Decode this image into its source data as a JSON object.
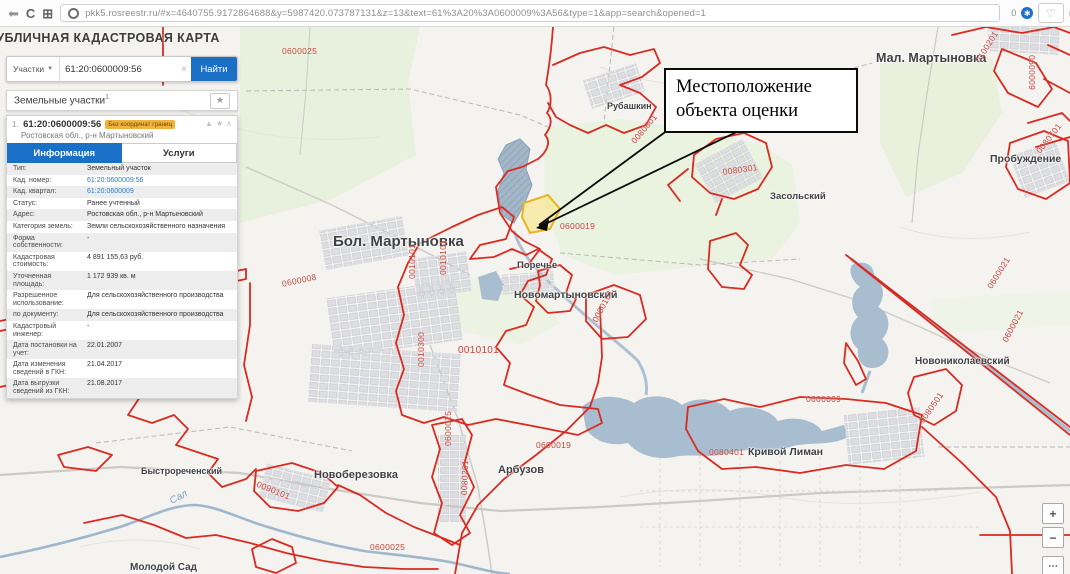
{
  "browser": {
    "url": "pkk5.rosreestr.ru/#x=4640755.9172864688&y=5987420.073787131&z=13&text=61%3A20%3A0600009%3A56&type=1&app=search&opened=1",
    "extension_count": "0"
  },
  "panel": {
    "title": "ПУБЛИЧНАЯ КАДАСТРОВАЯ КАРТА",
    "search": {
      "category": "Участки",
      "value": "61:20:0600009:56",
      "clear": "×",
      "button": "Найти"
    },
    "results": {
      "header": "Земельные участки",
      "count": "1"
    },
    "parcel": {
      "index": "1.",
      "number": "61:20:0600009:56",
      "badge": "Без координат границ",
      "subtitle": "Ростовская обл., р-н Мартыновский",
      "tabs": [
        {
          "label": "Информация",
          "active": true
        },
        {
          "label": "Услуги",
          "active": false
        }
      ]
    },
    "info_rows": [
      {
        "label": "Тип:",
        "value": "Земельный участок",
        "link": false
      },
      {
        "label": "Кад. номер:",
        "value": "61:20:0600009:56",
        "link": true
      },
      {
        "label": "Кад. квартал:",
        "value": "61:20:0600009",
        "link": true
      },
      {
        "label": "Статус:",
        "value": "Ранее учтенный",
        "link": false
      },
      {
        "label": "Адрес:",
        "value": "Ростовская обл., р-н Мартыновский",
        "link": false
      },
      {
        "label": "Категория земель:",
        "value": "Земли сельскохозяйственного назначения",
        "link": false
      },
      {
        "label": "Форма собственности:",
        "value": "-",
        "link": false
      },
      {
        "label": "Кадастровая стоимость:",
        "value": "4 891 155,63 руб.",
        "link": false
      },
      {
        "label": "Уточненная площадь:",
        "value": "1 172 939 кв. м",
        "link": false
      },
      {
        "label": "Разрешенное использование:",
        "value": "Для сельскохозяйственного производства",
        "link": false
      },
      {
        "label": "по документу:",
        "value": "Для сельскохозяйственного производства",
        "link": false
      },
      {
        "label": "Кадастровый инженер:",
        "value": "-",
        "link": false
      },
      {
        "label": "Дата постановки на учет:",
        "value": "22.01.2007",
        "link": false
      },
      {
        "label": "Дата изменения сведений в ГКН:",
        "value": "21.04.2017",
        "link": false
      },
      {
        "label": "Дата выгрузки сведений из ГКН:",
        "value": "21.08.2017",
        "link": false
      }
    ]
  },
  "annotation": {
    "text": "Местоположение объекта оценки"
  },
  "map": {
    "places": [
      {
        "text": "Бол. Мартыновка",
        "x": 333,
        "y": 206,
        "size": 15
      },
      {
        "text": "Мал. Мартыновка",
        "x": 876,
        "y": 24,
        "size": 12.5
      },
      {
        "text": "Рубашкин",
        "x": 607,
        "y": 74,
        "size": 9
      },
      {
        "text": "Пробуждение",
        "x": 990,
        "y": 126,
        "size": 10.5
      },
      {
        "text": "Засольский",
        "x": 770,
        "y": 164,
        "size": 9.5
      },
      {
        "text": "Поречье",
        "x": 517,
        "y": 233,
        "size": 9.5
      },
      {
        "text": "Новомартыновский",
        "x": 514,
        "y": 262,
        "size": 10.5
      },
      {
        "text": "Новониколаевский",
        "x": 915,
        "y": 329,
        "size": 10
      },
      {
        "text": "Кривой Лиман",
        "x": 748,
        "y": 419,
        "size": 10.5
      },
      {
        "text": "Арбузов",
        "x": 498,
        "y": 437,
        "size": 11
      },
      {
        "text": "Новоберезовка",
        "x": 314,
        "y": 442,
        "size": 11
      },
      {
        "text": "Быстрореченский",
        "x": 141,
        "y": 439,
        "size": 9
      },
      {
        "text": "Молодой Сад",
        "x": 130,
        "y": 535,
        "size": 10
      }
    ],
    "quarters": [
      {
        "text": "0600025",
        "x": 282,
        "y": 19,
        "rot": 0
      },
      {
        "text": "0100201",
        "x": 973,
        "y": 32,
        "rot": -58
      },
      {
        "text": "0600009",
        "x": 1037,
        "y": 28,
        "rot": 90
      },
      {
        "text": "0080701",
        "x": 1034,
        "y": 122,
        "rot": -52
      },
      {
        "text": "0080601",
        "x": 629,
        "y": 112,
        "rot": -50
      },
      {
        "text": "0080301",
        "x": 722,
        "y": 140,
        "rot": -8
      },
      {
        "text": "0600019",
        "x": 560,
        "y": 194,
        "rot": 0
      },
      {
        "text": "0600008",
        "x": 281,
        "y": 252,
        "rot": -12
      },
      {
        "text": "0010101",
        "x": 407,
        "y": 252,
        "rot": -90
      },
      {
        "text": "0010101",
        "x": 438,
        "y": 248,
        "rot": -90
      },
      {
        "text": "0010300",
        "x": 416,
        "y": 340,
        "rot": -90
      },
      {
        "text": "0010101",
        "x": 458,
        "y": 318,
        "rot": 0,
        "size": 10
      },
      {
        "text": "0080101",
        "x": 590,
        "y": 292,
        "rot": -62
      },
      {
        "text": "0600021",
        "x": 985,
        "y": 258,
        "rot": -58
      },
      {
        "text": "0600021",
        "x": 1000,
        "y": 312,
        "rot": -62
      },
      {
        "text": "0080501",
        "x": 917,
        "y": 392,
        "rot": -55
      },
      {
        "text": "0600009",
        "x": 806,
        "y": 367,
        "rot": 0
      },
      {
        "text": "0080401",
        "x": 709,
        "y": 420,
        "rot": 0
      },
      {
        "text": "0600019",
        "x": 536,
        "y": 413,
        "rot": 0
      },
      {
        "text": "0600025",
        "x": 443,
        "y": 419,
        "rot": -90
      },
      {
        "text": "0080201",
        "x": 459,
        "y": 468,
        "rot": -88
      },
      {
        "text": "0090101",
        "x": 259,
        "y": 452,
        "rot": 22
      },
      {
        "text": "0600025",
        "x": 370,
        "y": 515,
        "rot": 0
      },
      {
        "text": "0600008",
        "x": 160,
        "y": 353,
        "rot": 0
      }
    ],
    "river_label": {
      "text": "Сал",
      "x": 168,
      "y": 470,
      "rot": -28
    },
    "zoom_controls": [
      {
        "label": "+",
        "name": "zoom-in-button"
      },
      {
        "label": "−",
        "name": "zoom-out-button"
      },
      {
        "label": "⋯",
        "name": "map-tools-button"
      }
    ]
  }
}
